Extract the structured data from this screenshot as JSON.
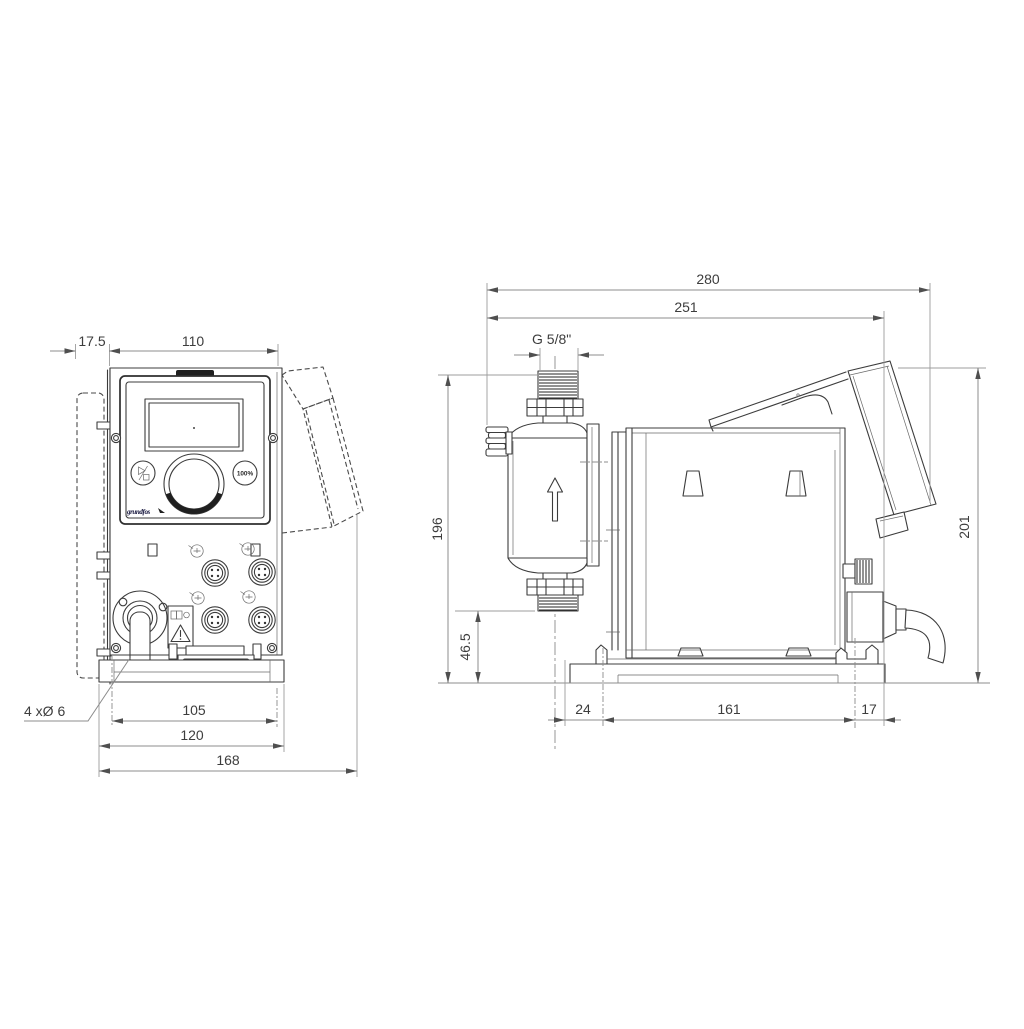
{
  "front_view": {
    "dimensions": {
      "bracket_offset": "17.5",
      "housing_width": "110",
      "hole_pitch": "105",
      "plate_width": "120",
      "overall_width": "168"
    },
    "holes_note": "4 xØ 6",
    "control_panel": {
      "percent_button": "100%",
      "logo": "grundfos"
    }
  },
  "side_view": {
    "dimensions": {
      "overall_depth": "280",
      "depth_to_cover": "251",
      "connection_thread": "G 5/8\"",
      "height_to_connection": "196",
      "suction_height": "46.5",
      "overall_height": "201",
      "front_offset": "24",
      "foot_length": "161",
      "rear_offset": "17"
    }
  }
}
